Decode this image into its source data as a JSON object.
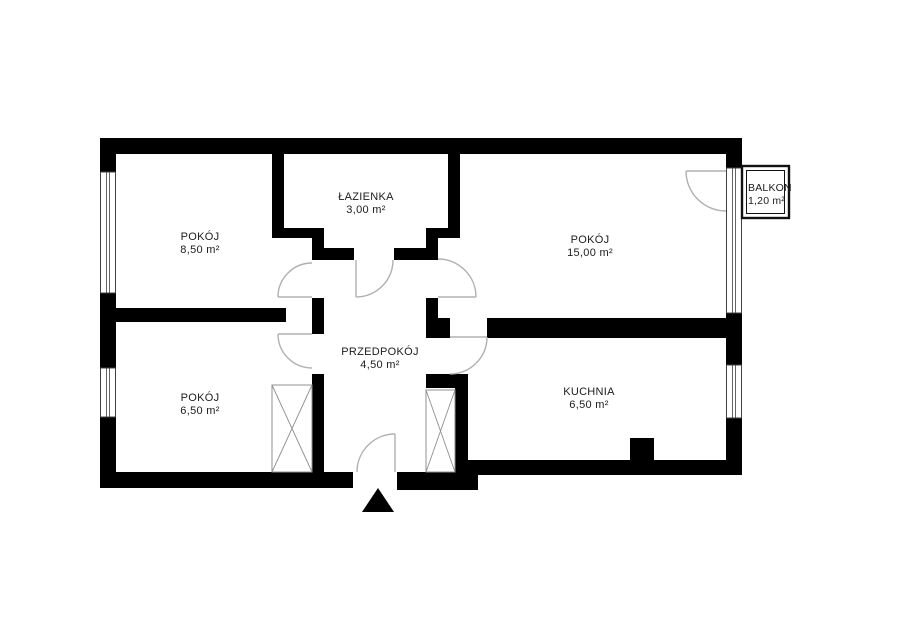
{
  "plan": {
    "title": "apartment-floor-plan",
    "rooms": [
      {
        "id": "pokoj-850",
        "name": "POKÓJ",
        "area": "8,50 m²"
      },
      {
        "id": "lazienka",
        "name": "ŁAZIENKA",
        "area": "3,00 m²"
      },
      {
        "id": "pokoj-1500",
        "name": "POKÓJ",
        "area": "15,00 m²"
      },
      {
        "id": "przedpokoj",
        "name": "PRZEDPOKÓJ",
        "area": "4,50 m²"
      },
      {
        "id": "pokoj-650",
        "name": "POKÓJ",
        "area": "6,50 m²"
      },
      {
        "id": "kuchnia",
        "name": "KUCHNIA",
        "area": "6,50 m²"
      },
      {
        "id": "balkon",
        "name": "BALKON",
        "area": "1,20 m²"
      }
    ],
    "colors": {
      "wall": "#000000",
      "door_arc": "#b0b0b0",
      "text": "#1c1c1c",
      "background": "#ffffff"
    }
  }
}
